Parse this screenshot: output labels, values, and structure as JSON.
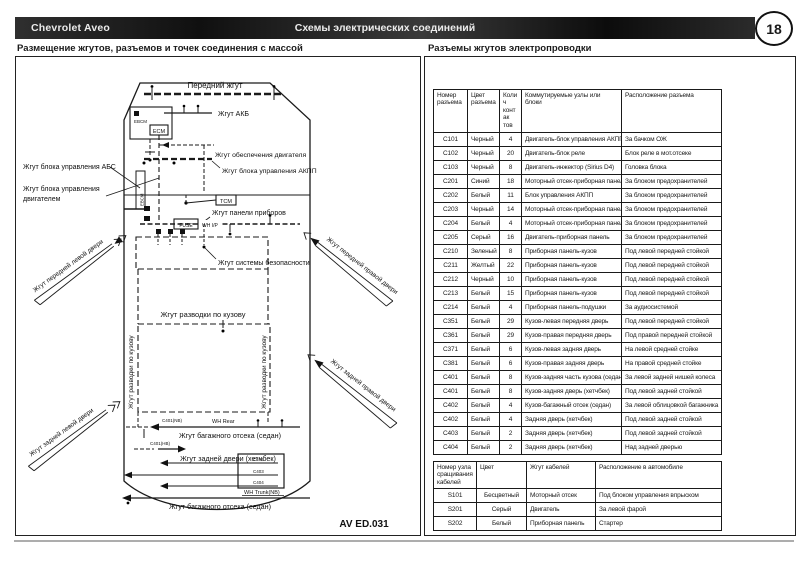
{
  "header": {
    "brand": "Chevrolet Aveo",
    "title": "Схемы электрических соединений",
    "page_number": "18"
  },
  "sections": {
    "left_title": "Размещение жгутов, разъемов и точек соединения с массой",
    "right_title": "Разъемы жгутов электропроводки"
  },
  "diagram": {
    "drawing_number": "AV ED.031",
    "labels": {
      "front": "Передний жгут",
      "battery": "Жгут АКБ",
      "engine_supply": "Жгут обеспечения двигателя",
      "akpp": "Жгут блока управления АКПП",
      "abs": "Жгут блока управления АБС",
      "engine_ecu_1": "Жгут блока управления",
      "engine_ecu_2": "двигателем",
      "dash": "Жгут панели приборов",
      "safety": "Жгут системы безопасности",
      "body_h": "Жгут разводки по кузову",
      "body_v_left": "Жгут разводки по кузову",
      "body_v_right": "Жгут разводки по кузову",
      "door_fl": "Жгут передней левой двери",
      "door_rl": "Жгут задней левой двери",
      "door_fr": "Жгут передней правой двери",
      "door_rr": "Жгут задней правой двери",
      "trunk_sedan_1": "Жгут багажного отсека (седан)",
      "hatch_door": "Жгут задней двери (хетчбек)",
      "trunk_sedan_2": "Жгут багажного отсека (седан)",
      "wh_rear": "WH Rear",
      "wh_trunk": "WH Trunk(NB)",
      "wh_ip": "WH I/P",
      "ecm": "ECM",
      "tcm": "TCM",
      "fuse": "FUSE",
      "ebcm": "EBCM",
      "c401nb": "C401(NB)",
      "c401hb": "C401(HB)",
      "c402": "C402",
      "c403": "C403",
      "c404": "C404"
    }
  },
  "connector_table": {
    "headers": [
      "Номер разъема",
      "Цвет разъема",
      "Колич контак тов",
      "Коммутируемые узлы или блоки",
      "Расположение разъема"
    ],
    "rows": [
      [
        "C101",
        "Черный",
        "4",
        "Двигатель-блок управления АКПП",
        "За бачком ОЖ"
      ],
      [
        "C102",
        "Черный",
        "20",
        "Двигатель-блок реле",
        "Блок реле в мот.отсеке"
      ],
      [
        "C103",
        "Черный",
        "8",
        "Двигатель-инжектор (Sirius D4)",
        "Головка блока"
      ],
      [
        "C201",
        "Синий",
        "18",
        "Моторный отсек-приборная панель",
        "За блоком предохранителей"
      ],
      [
        "C202",
        "Белый",
        "11",
        "Блок управления АКПП",
        "За блоком предохранителей"
      ],
      [
        "C203",
        "Черный",
        "14",
        "Моторный отсек-приборная панель",
        "За блоком предохранителей"
      ],
      [
        "C204",
        "Белый",
        "4",
        "Моторный отсек-приборная панель",
        "За блоком предохранителей"
      ],
      [
        "C205",
        "Серый",
        "16",
        "Двигатель-приборная панель",
        "За блоком предохранителей"
      ],
      [
        "C210",
        "Зеленый",
        "8",
        "Приборная панель-кузов",
        "Под левой передней стойкой"
      ],
      [
        "C211",
        "Желтый",
        "22",
        "Приборная панель-кузов",
        "Под левой передней стойкой"
      ],
      [
        "C212",
        "Черный",
        "10",
        "Приборная панель-кузов",
        "Под левой передней стойкой"
      ],
      [
        "C213",
        "Белый",
        "15",
        "Приборная панель-кузов",
        "Под левой передней стойкой"
      ],
      [
        "C214",
        "Белый",
        "4",
        "Приборная панель-подушки",
        "За аудиосистемой"
      ],
      [
        "C351",
        "Белый",
        "29",
        "Кузов-левая передняя дверь",
        "Под левой передней стойкой"
      ],
      [
        "C361",
        "Белый",
        "29",
        "Кузов-правая передняя дверь",
        "Под правой передней стойкой"
      ],
      [
        "C371",
        "Белый",
        "6",
        "Кузов-левая задняя дверь",
        "На левой средней стойке"
      ],
      [
        "C381",
        "Белый",
        "6",
        "Кузов-правая задняя дверь",
        "На правой средней стойке"
      ],
      [
        "C401",
        "Белый",
        "8",
        "Кузов-задняя часть кузова (седан)",
        "За левой задней нишей колеса"
      ],
      [
        "C401",
        "Белый",
        "8",
        "Кузов-задняя дверь (хетчбек)",
        "Под левой задней стойкой"
      ],
      [
        "C402",
        "Белый",
        "4",
        "Кузов-багажный отсек (седан)",
        "За левой облицовкой багажника"
      ],
      [
        "C402",
        "Белый",
        "4",
        "Задняя дверь (хетчбек)",
        "Под левой задней стойкой"
      ],
      [
        "C403",
        "Белый",
        "2",
        "Задняя дверь (хетчбек)",
        "Под левой задней стойкой"
      ],
      [
        "C404",
        "Белый",
        "2",
        "Задняя дверь (хетчбек)",
        "Над задней дверью"
      ]
    ]
  },
  "splice_table": {
    "headers": [
      "Номер узла сращивания кабелей",
      "Цвет",
      "Жгут кабелей",
      "Расположение в автомобиле"
    ],
    "rows": [
      [
        "S101",
        "Бесцветный",
        "Моторный отсек",
        "Под блоком управления впрыском"
      ],
      [
        "S201",
        "Серый",
        "Двигатель",
        "За левой фарой"
      ],
      [
        "S202",
        "Белый",
        "Приборная панель",
        "Стартер"
      ]
    ]
  }
}
